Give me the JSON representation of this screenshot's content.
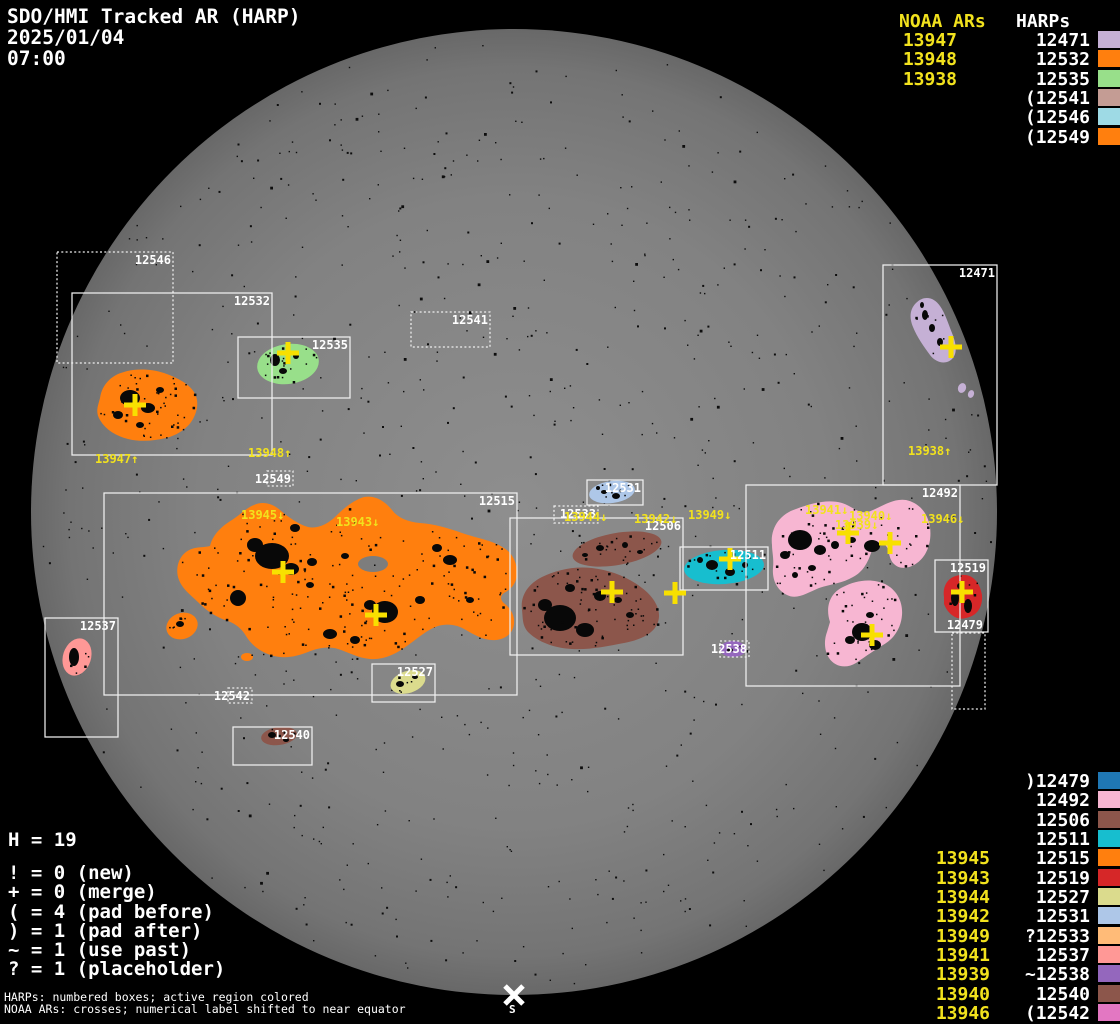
{
  "title": {
    "line1": "SDO/HMI Tracked AR (HARP)",
    "line2": "2025/01/04",
    "line3": "07:00"
  },
  "top_right_table": {
    "noaa_header": "NOAA ARs",
    "harp_header": "HARPs",
    "rows": [
      {
        "noaa": "13947",
        "harp": "12471",
        "color": "#c5b0d5"
      },
      {
        "noaa": "13948",
        "harp": "12532",
        "color": "#ff7f0e"
      },
      {
        "noaa": "13938",
        "harp": "12535",
        "color": "#98df8a"
      },
      {
        "noaa": "",
        "harp": "(12541",
        "color": "#c49c94"
      },
      {
        "noaa": "",
        "harp": "(12546",
        "color": "#9edae5"
      },
      {
        "noaa": "",
        "harp": "(12549",
        "color": "#ff7f0e"
      }
    ]
  },
  "bottom_right_table": {
    "rows": [
      {
        "noaa": "",
        "harp": ")12479",
        "color": "#1f77b4"
      },
      {
        "noaa": "",
        "harp": "12492",
        "color": "#f7b6d2"
      },
      {
        "noaa": "",
        "harp": "12506",
        "color": "#8c564b"
      },
      {
        "noaa": "",
        "harp": "12511",
        "color": "#17becf"
      },
      {
        "noaa": "13945",
        "harp": "12515",
        "color": "#ff7f0e"
      },
      {
        "noaa": "13943",
        "harp": "12519",
        "color": "#d62728"
      },
      {
        "noaa": "13944",
        "harp": "12527",
        "color": "#dbdb8d"
      },
      {
        "noaa": "13942",
        "harp": "12531",
        "color": "#aec7e8"
      },
      {
        "noaa": "13949",
        "harp": "?12533",
        "color": "#ffbb78"
      },
      {
        "noaa": "13941",
        "harp": "12537",
        "color": "#ff9896"
      },
      {
        "noaa": "13939",
        "harp": "~12538",
        "color": "#9467bd"
      },
      {
        "noaa": "13940",
        "harp": "12540",
        "color": "#8c564b"
      },
      {
        "noaa": "13946",
        "harp": "(12542",
        "color": "#e377c2"
      }
    ]
  },
  "legend": {
    "harp_count": "H = 19",
    "items": [
      "! = 0 (new)",
      "+ = 0 (merge)",
      "( = 4 (pad before)",
      ") = 1 (pad after)",
      "~ = 1 (use past)",
      "? = 1 (placeholder)"
    ]
  },
  "footer": {
    "line1": "HARPs: numbered boxes; active region colored",
    "line2": "NOAA ARs: crosses; numerical label shifted to near equator"
  },
  "south_marker_label": "S",
  "chart_data": {
    "type": "scatter",
    "title": "SDO/HMI Tracked AR (HARP)",
    "date": "2025/01/04",
    "time": "07:00",
    "harp_count": 19,
    "counts": {
      "new": 0,
      "merge": 0,
      "pad_before": 4,
      "pad_after": 1,
      "use_past": 1,
      "placeholder": 1
    },
    "disk": {
      "cx": 514,
      "cy": 512,
      "r": 483
    },
    "regions": [
      {
        "harp": "12546",
        "box": [
          57,
          252,
          116,
          111
        ],
        "dotted": true,
        "color": "#9edae5",
        "crosses": []
      },
      {
        "harp": "12532",
        "box": [
          72,
          293,
          200,
          162
        ],
        "dotted": false,
        "color": "#ff7f0e",
        "crosses": [
          [
            135,
            405
          ]
        ]
      },
      {
        "harp": "12535",
        "box": [
          238,
          337,
          112,
          61
        ],
        "dotted": false,
        "color": "#98df8a",
        "crosses": [
          [
            288,
            353
          ]
        ]
      },
      {
        "harp": "12541",
        "box": [
          411,
          312,
          79,
          35
        ],
        "dotted": true,
        "color": "#c49c94",
        "crosses": []
      },
      {
        "harp": "12549",
        "box": [
          267,
          471,
          26,
          15
        ],
        "dotted": true,
        "color": "#ff7f0e",
        "crosses": []
      },
      {
        "harp": "12515",
        "box": [
          104,
          493,
          413,
          202
        ],
        "dotted": false,
        "color": "#ff7f0e",
        "crosses": [
          [
            283,
            572
          ],
          [
            376,
            615
          ]
        ]
      },
      {
        "harp": "12542",
        "box": [
          228,
          688,
          24,
          15
        ],
        "dotted": true,
        "color": "#e377c2",
        "crosses": []
      },
      {
        "harp": "12537",
        "box": [
          45,
          618,
          73,
          119
        ],
        "dotted": false,
        "color": "#ff9896",
        "crosses": []
      },
      {
        "harp": "12540",
        "box": [
          233,
          727,
          79,
          38
        ],
        "dotted": false,
        "color": "#8c564b",
        "crosses": []
      },
      {
        "harp": "12527",
        "box": [
          372,
          664,
          63,
          38
        ],
        "dotted": false,
        "color": "#dbdb8d",
        "crosses": []
      },
      {
        "harp": "12531",
        "box": [
          587,
          480,
          56,
          25
        ],
        "dotted": false,
        "color": "#aec7e8",
        "crosses": []
      },
      {
        "harp": "12533",
        "box": [
          554,
          506,
          44,
          17
        ],
        "dotted": true,
        "color": "#ffbb78",
        "crosses": []
      },
      {
        "harp": "12506",
        "box": [
          510,
          518,
          173,
          137
        ],
        "dotted": false,
        "color": "#8c564b",
        "crosses": [
          [
            612,
            592
          ],
          [
            675,
            593
          ]
        ]
      },
      {
        "harp": "12511",
        "box": [
          680,
          547,
          88,
          43
        ],
        "dotted": false,
        "color": "#17becf",
        "crosses": [
          [
            730,
            559
          ]
        ]
      },
      {
        "harp": "12538",
        "box": [
          720,
          641,
          29,
          16
        ],
        "dotted": true,
        "color": "#9467bd",
        "crosses": []
      },
      {
        "harp": "12492",
        "box": [
          746,
          485,
          214,
          201
        ],
        "dotted": false,
        "color": "#f7b6d2",
        "crosses": [
          [
            848,
            533
          ],
          [
            890,
            543
          ],
          [
            872,
            635
          ]
        ]
      },
      {
        "harp": "12519",
        "box": [
          935,
          560,
          53,
          72
        ],
        "dotted": false,
        "color": "#d62728",
        "crosses": [
          [
            962,
            592
          ]
        ]
      },
      {
        "harp": "12479",
        "box": [
          952,
          633,
          33,
          76
        ],
        "dotted": true,
        "color": "#1f77b4",
        "crosses": [],
        "label_above": true
      },
      {
        "harp": "12471",
        "box": [
          883,
          265,
          114,
          220
        ],
        "dotted": false,
        "color": "#c5b0d5",
        "crosses": [
          [
            951,
            347
          ]
        ]
      }
    ],
    "noaa_disk_labels": [
      {
        "text": "13947↑",
        "x": 95,
        "y": 453
      },
      {
        "text": "13948↑",
        "x": 248,
        "y": 447
      },
      {
        "text": "13945↓",
        "x": 241,
        "y": 509
      },
      {
        "text": "13943↓",
        "x": 336,
        "y": 516
      },
      {
        "text": "13944↓",
        "x": 564,
        "y": 511
      },
      {
        "text": "13942↓",
        "x": 634,
        "y": 513
      },
      {
        "text": "13949↓",
        "x": 688,
        "y": 509
      },
      {
        "text": "13941↓",
        "x": 805,
        "y": 504
      },
      {
        "text": "13940↓",
        "x": 849,
        "y": 510
      },
      {
        "text": "13939↓",
        "x": 835,
        "y": 519
      },
      {
        "text": "13946↓",
        "x": 921,
        "y": 513
      },
      {
        "text": "13938↑",
        "x": 908,
        "y": 445
      }
    ]
  }
}
